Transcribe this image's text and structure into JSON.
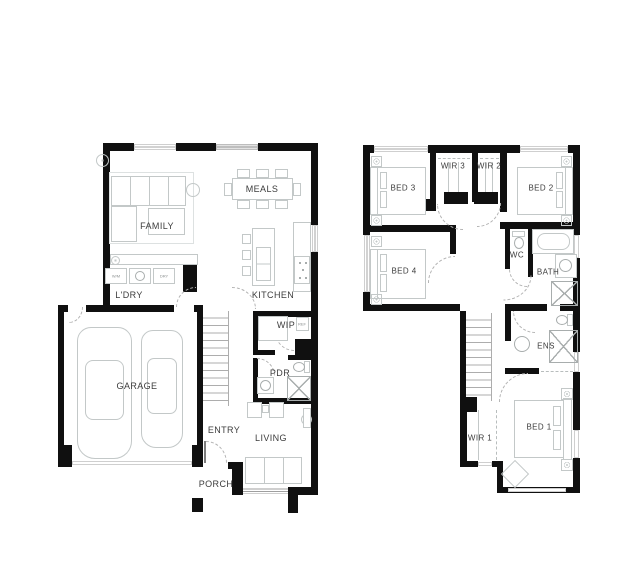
{
  "ground_floor": {
    "rooms": {
      "family": "FAMILY",
      "meals": "MEALS",
      "kitchen": "KITCHEN",
      "laundry": "L'DRY",
      "wip": "WIP",
      "pdr": "PDR",
      "garage": "GARAGE",
      "entry": "ENTRY",
      "living": "LIVING",
      "porch": "PORCH"
    },
    "appliances": {
      "washer": "W/M",
      "dryer": "DRY",
      "fridge": "REF"
    }
  },
  "first_floor": {
    "rooms": {
      "bed1": "BED 1",
      "bed2": "BED 2",
      "bed3": "BED 3",
      "bed4": "BED 4",
      "wir1": "WIR 1",
      "wir2": "WIR 2",
      "wir3": "WIR 3",
      "wc": "WC",
      "bath": "BATH",
      "ens": "ENS"
    }
  },
  "colors": {
    "wall": "#101010",
    "window_line": "#a6a6a6",
    "furniture_outline": "#c3c8c8",
    "label_text": "#3c3c3c",
    "background": "#ffffff"
  }
}
